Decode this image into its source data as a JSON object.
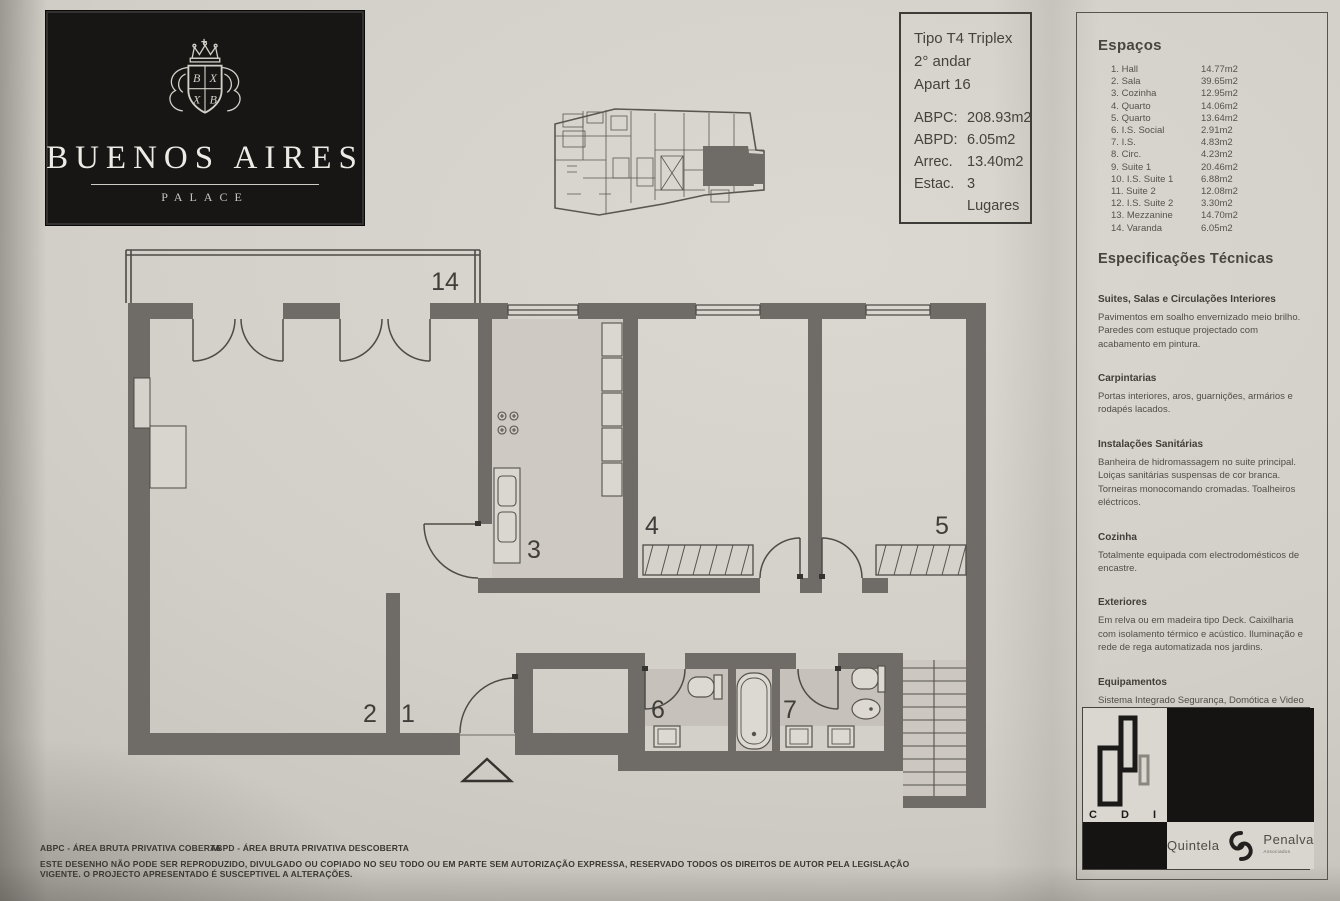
{
  "colors": {
    "paper": "#d2cfc8",
    "wall": "#6f6b66",
    "line": "#4e4b47",
    "bath_floor": "#c6c2bb",
    "black_panel": "#171614"
  },
  "logo_box": {
    "title": "BUENOS AIRES",
    "subtitle": "PALACE",
    "crest_quarters": [
      "B",
      "X",
      "X",
      "B"
    ]
  },
  "info_box": {
    "lines": [
      "Tipo T4 Triplex",
      "2° andar",
      "Apart 16"
    ],
    "metrics": [
      {
        "label": "ABPC:",
        "value": "208.93m2"
      },
      {
        "label": "ABPD:",
        "value": "6.05m2"
      },
      {
        "label": "Arrec.",
        "value": "13.40m2"
      },
      {
        "label": "Estac.",
        "value": "3 Lugares"
      }
    ]
  },
  "espacos": {
    "title": "Espaços",
    "rooms": [
      {
        "num": "1.",
        "name": "Hall",
        "area": "14.77m2"
      },
      {
        "num": "2.",
        "name": "Sala",
        "area": "39.65m2"
      },
      {
        "num": "3.",
        "name": "Cozinha",
        "area": "12.95m2"
      },
      {
        "num": "4.",
        "name": "Quarto",
        "area": "14.06m2"
      },
      {
        "num": "5.",
        "name": "Quarto",
        "area": "13.64m2"
      },
      {
        "num": "6.",
        "name": "I.S. Social",
        "area": "2.91m2"
      },
      {
        "num": "7.",
        "name": "I.S.",
        "area": "4.83m2"
      },
      {
        "num": "8.",
        "name": "Circ.",
        "area": "4.23m2"
      },
      {
        "num": "9.",
        "name": "Suite 1",
        "area": "20.46m2"
      },
      {
        "num": "10.",
        "name": "I.S. Suite 1",
        "area": "6.88m2"
      },
      {
        "num": "11.",
        "name": "Suite 2",
        "area": "12.08m2"
      },
      {
        "num": "12.",
        "name": "I.S. Suite 2",
        "area": "3.30m2"
      },
      {
        "num": "13.",
        "name": "Mezzanine",
        "area": "14.70m2"
      },
      {
        "num": "14.",
        "name": "Varanda",
        "area": "6.05m2"
      }
    ]
  },
  "specs": {
    "title": "Especificações Técnicas",
    "sections": [
      {
        "heading": "Suites, Salas e Circulações Interiores",
        "body": "Pavimentos em soalho envernizado meio brilho. Paredes com estuque projectado com acabamento em pintura."
      },
      {
        "heading": "Carpintarias",
        "body": "Portas interiores, aros, guarnições, armários e rodapés lacados."
      },
      {
        "heading": "Instalações Sanitárias",
        "body": "Banheira de hidromassagem no suite principal. Loiças sanitárias suspensas de cor branca. Torneiras monocomando cromadas. Toalheiros eléctricos."
      },
      {
        "heading": "Cozinha",
        "body": "Totalmente equipada com electrodomésticos de encastre."
      },
      {
        "heading": "Exteriores",
        "body": "Em relva ou em madeira tipo Deck. Caixilharia com isolamento térmico e acústico. Iluminação e rede de rega automatizada nos jardins."
      },
      {
        "heading": "Equipamentos",
        "body": "Sistema Integrado Segurança, Domótica e Video porteiro. Sistema de climatização através bomba calor com grelhas de distribuição nas paredes e tectos."
      }
    ]
  },
  "floorplan": {
    "labels": {
      "varanda": "14",
      "sala": "2",
      "hall": "1",
      "cozinha": "3",
      "quarto_4": "4",
      "quarto_5": "5",
      "is_social": "6",
      "is": "7"
    }
  },
  "brand": {
    "cdi": {
      "letters": [
        "C",
        "D",
        "I"
      ]
    },
    "quintela": "Quintela",
    "penalva": "Penalva",
    "penalva_sub": "Associados"
  },
  "footer": {
    "abpc": "ABPC - ÁREA BRUTA PRIVATIVA COBERTA",
    "abpd": "ABPD - ÁREA BRUTA PRIVATIVA DESCOBERTA",
    "disclaimer": "ESTE DESENHO NÃO PODE SER REPRODUZIDO, DIVULGADO OU COPIADO NO SEU TODO OU EM PARTE SEM AUTORIZAÇÃO EXPRESSA, RESERVADO TODOS OS DIREITOS DE AUTOR PELA LEGISLAÇÃO VIGENTE. O PROJECTO APRESENTADO É SUSCEPTIVEL A ALTERAÇÕES."
  }
}
